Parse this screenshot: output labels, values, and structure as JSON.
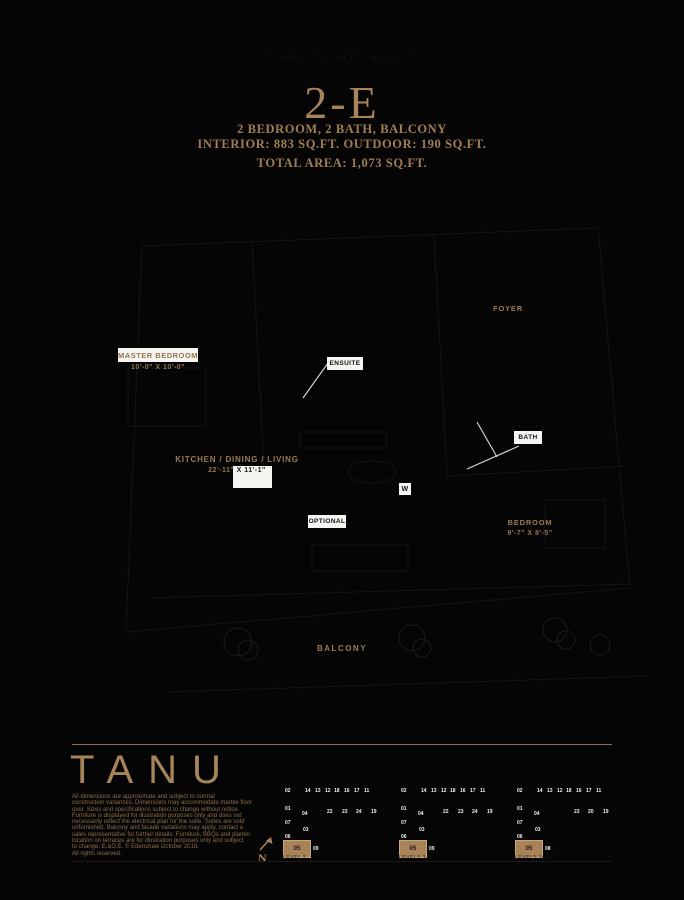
{
  "colors": {
    "background": "#050505",
    "accent_tan": "#a6845c",
    "label_tan": "#9c7b52",
    "white_box": "#f7f5f1",
    "footer_rule": "#8a6d4a"
  },
  "header": {
    "faint_title": "TANU | PORT CREDIT"
  },
  "title": {
    "unit": "2-E",
    "subtitle": "2 BEDROOM, 2 BATH, BALCONY",
    "areas": "INTERIOR: 883 SQ.FT. OUTDOOR: 190 SQ.FT.",
    "total": "TOTAL AREA: 1,073 SQ.FT."
  },
  "plan": {
    "labels": {
      "foyer": "FOYER",
      "master_bedroom": "MASTER BEDROOM",
      "master_dims": "10'-0\" X 10'-0\"",
      "ensuite": "ENSUITE",
      "bath": "BATH",
      "kitchen": "KITCHEN / DINING / LIVING",
      "kitchen_dims_left": "22'-11\" ",
      "kitchen_dims_right": "X 11'-1\"",
      "washer": "W",
      "optional": "OPTIONAL",
      "bedroom": "BEDROOM",
      "bedroom_dims": "9'-7\" X 8'-5\"",
      "balcony": "BALCONY"
    }
  },
  "footer": {
    "logo": "TANU",
    "compass_label": "N",
    "disclaimer_lines": [
      "All dimensions are approximate and subject to normal",
      "construction variances. Dimensions may accommodate marble floor",
      "over. Sizes and specifications subject to change without notice.",
      "Furniture is displayed for illustration purposes only and does not",
      "necessarily reflect the electrical plan for the suite. Suites are sold",
      "unfurnished. Balcony and facade variations may apply, contact a",
      "sales representative for further details. Furniture, BBQs and planter",
      "location on terraces are for illustration purposes only and subject",
      "to change. E.&O.E. © Edenshaw October 2018.",
      "All rights reserved."
    ],
    "keyplans": [
      {
        "caption": "LEVEL 2",
        "cells": [
          {
            "t": "02",
            "x": 2,
            "y": 4
          },
          {
            "t": "14",
            "x": 22,
            "y": 4
          },
          {
            "t": "13",
            "x": 32,
            "y": 4
          },
          {
            "t": "12",
            "x": 42,
            "y": 4
          },
          {
            "t": "18",
            "x": 51,
            "y": 4
          },
          {
            "t": "16",
            "x": 61,
            "y": 4
          },
          {
            "t": "17",
            "x": 71,
            "y": 4
          },
          {
            "t": "11",
            "x": 81,
            "y": 4
          },
          {
            "t": "01",
            "x": 2,
            "y": 22
          },
          {
            "t": "04",
            "x": 19,
            "y": 27
          },
          {
            "t": "22",
            "x": 44,
            "y": 25
          },
          {
            "t": "23",
            "x": 59,
            "y": 25
          },
          {
            "t": "24",
            "x": 73,
            "y": 25
          },
          {
            "t": "19",
            "x": 88,
            "y": 25
          },
          {
            "t": "07",
            "x": 2,
            "y": 36
          },
          {
            "t": "03",
            "x": 20,
            "y": 43
          },
          {
            "t": "06",
            "x": 2,
            "y": 50
          },
          {
            "t": "05",
            "x": 0,
            "y": 56,
            "hl": true
          },
          {
            "t": "09",
            "x": 30,
            "y": 62
          }
        ]
      },
      {
        "caption": "LEVELS 3-9",
        "cells": [
          {
            "t": "02",
            "x": 2,
            "y": 4
          },
          {
            "t": "14",
            "x": 22,
            "y": 4
          },
          {
            "t": "13",
            "x": 32,
            "y": 4
          },
          {
            "t": "12",
            "x": 42,
            "y": 4
          },
          {
            "t": "18",
            "x": 51,
            "y": 4
          },
          {
            "t": "16",
            "x": 61,
            "y": 4
          },
          {
            "t": "17",
            "x": 71,
            "y": 4
          },
          {
            "t": "11",
            "x": 81,
            "y": 4
          },
          {
            "t": "01",
            "x": 2,
            "y": 22
          },
          {
            "t": "04",
            "x": 19,
            "y": 27
          },
          {
            "t": "22",
            "x": 44,
            "y": 25
          },
          {
            "t": "23",
            "x": 59,
            "y": 25
          },
          {
            "t": "24",
            "x": 73,
            "y": 25
          },
          {
            "t": "19",
            "x": 88,
            "y": 25
          },
          {
            "t": "07",
            "x": 2,
            "y": 36
          },
          {
            "t": "03",
            "x": 20,
            "y": 43
          },
          {
            "t": "06",
            "x": 2,
            "y": 50
          },
          {
            "t": "05",
            "x": 0,
            "y": 56,
            "hl": true
          },
          {
            "t": "09",
            "x": 30,
            "y": 62
          }
        ]
      },
      {
        "caption": "LEVELS 10-15",
        "cells": [
          {
            "t": "02",
            "x": 2,
            "y": 4
          },
          {
            "t": "14",
            "x": 22,
            "y": 4
          },
          {
            "t": "13",
            "x": 32,
            "y": 4
          },
          {
            "t": "12",
            "x": 42,
            "y": 4
          },
          {
            "t": "18",
            "x": 51,
            "y": 4
          },
          {
            "t": "16",
            "x": 61,
            "y": 4
          },
          {
            "t": "17",
            "x": 71,
            "y": 4
          },
          {
            "t": "11",
            "x": 81,
            "y": 4
          },
          {
            "t": "01",
            "x": 2,
            "y": 22
          },
          {
            "t": "04",
            "x": 19,
            "y": 27
          },
          {
            "t": "23",
            "x": 59,
            "y": 25
          },
          {
            "t": "20",
            "x": 73,
            "y": 25
          },
          {
            "t": "19",
            "x": 88,
            "y": 25
          },
          {
            "t": "07",
            "x": 2,
            "y": 36
          },
          {
            "t": "03",
            "x": 20,
            "y": 43
          },
          {
            "t": "06",
            "x": 2,
            "y": 50
          },
          {
            "t": "05",
            "x": 0,
            "y": 56,
            "hl": true
          },
          {
            "t": "08",
            "x": 30,
            "y": 62
          }
        ]
      }
    ]
  }
}
